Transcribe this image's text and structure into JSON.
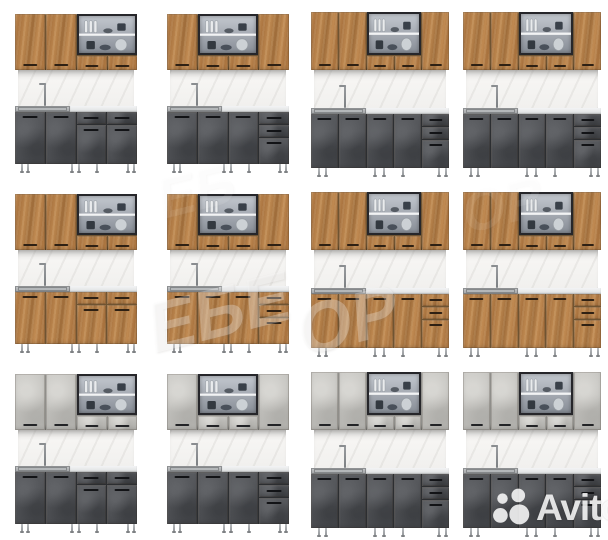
{
  "page": {
    "width": 608,
    "height": 540,
    "background": "#ffffff",
    "content_type": "product-photo-collage"
  },
  "grid": {
    "rows": 3,
    "cols": 4,
    "cell_width": 152,
    "cell_height": 180
  },
  "materials": {
    "oak": {
      "name": "oak-wood",
      "base": "#b07c46",
      "gap": "#6f5432",
      "handle": "#2e2013"
    },
    "dark": {
      "name": "dark-graphite",
      "base": "#515357",
      "gap": "#2c2e31",
      "handle": "#121316"
    },
    "concrete": {
      "name": "light-concrete",
      "base": "#c2c1bd",
      "gap": "#8f8e8a",
      "handle": "#222326"
    }
  },
  "shared_colors": {
    "backsplash": "#f2f1ef",
    "counter_sink": "#aeb1b3",
    "counter_top": "#e9ebec",
    "glass_frame": "#26262a",
    "legs": "#a5a8ab",
    "background": "#ffffff"
  },
  "layouts": {
    "compact-a": {
      "upper": [
        "door",
        "door",
        "glass"
      ],
      "upper_w": [
        1,
        1,
        2
      ],
      "lower": [
        "door",
        "door",
        "drawer-door",
        "drawer-door"
      ],
      "lower_w": [
        1,
        1,
        1,
        1
      ]
    },
    "compact-b": {
      "upper": [
        "door",
        "glass",
        "door"
      ],
      "upper_w": [
        1,
        2,
        1
      ],
      "lower": [
        "door",
        "door",
        "door",
        "drawers-door"
      ],
      "lower_w": [
        1,
        1,
        1,
        1
      ]
    },
    "wide": {
      "upper": [
        "door",
        "door",
        "glass",
        "door"
      ],
      "upper_w": [
        1,
        1,
        2,
        1
      ],
      "lower": [
        "door",
        "door",
        "door",
        "door",
        "drawers-door"
      ],
      "lower_w": [
        1,
        1,
        1,
        1,
        1
      ]
    }
  },
  "kitchens": [
    {
      "id": "kitchen-r1-c1",
      "row": 0,
      "col": 0,
      "size": "compact",
      "layout": "compact-a",
      "upper": "oak",
      "lower": "dark"
    },
    {
      "id": "kitchen-r1-c2",
      "row": 0,
      "col": 1,
      "size": "compact",
      "layout": "compact-b",
      "upper": "oak",
      "lower": "dark"
    },
    {
      "id": "kitchen-r1-c3",
      "row": 0,
      "col": 2,
      "size": "wide",
      "layout": "wide",
      "upper": "oak",
      "lower": "dark"
    },
    {
      "id": "kitchen-r1-c4",
      "row": 0,
      "col": 3,
      "size": "wide",
      "layout": "wide",
      "upper": "oak",
      "lower": "dark"
    },
    {
      "id": "kitchen-r2-c1",
      "row": 1,
      "col": 0,
      "size": "compact",
      "layout": "compact-a",
      "upper": "oak",
      "lower": "oak"
    },
    {
      "id": "kitchen-r2-c2",
      "row": 1,
      "col": 1,
      "size": "compact",
      "layout": "compact-b",
      "upper": "oak",
      "lower": "oak"
    },
    {
      "id": "kitchen-r2-c3",
      "row": 1,
      "col": 2,
      "size": "wide",
      "layout": "wide",
      "upper": "oak",
      "lower": "oak"
    },
    {
      "id": "kitchen-r2-c4",
      "row": 1,
      "col": 3,
      "size": "wide",
      "layout": "wide",
      "upper": "oak",
      "lower": "oak"
    },
    {
      "id": "kitchen-r3-c1",
      "row": 2,
      "col": 0,
      "size": "compact",
      "layout": "compact-a",
      "upper": "concrete",
      "lower": "dark"
    },
    {
      "id": "kitchen-r3-c2",
      "row": 2,
      "col": 1,
      "size": "compact",
      "layout": "compact-b",
      "upper": "concrete",
      "lower": "dark"
    },
    {
      "id": "kitchen-r3-c3",
      "row": 2,
      "col": 2,
      "size": "wide",
      "layout": "wide",
      "upper": "concrete",
      "lower": "dark"
    },
    {
      "id": "kitchen-r3-c4",
      "row": 2,
      "col": 3,
      "size": "wide",
      "layout": "wide",
      "upper": "concrete",
      "lower": "dark"
    }
  ],
  "geometry": {
    "compact": {
      "left": 15,
      "top": 14,
      "width": 122,
      "upper_h": 56,
      "splash_h": 36,
      "counter_h": 6,
      "lower_h": 52,
      "leg_h": 9,
      "short_door_h": 16,
      "sink_frac": 0.45
    },
    "wide": {
      "left": 7,
      "top": 12,
      "width": 138,
      "upper_h": 58,
      "splash_h": 38,
      "counter_h": 6,
      "lower_h": 54,
      "leg_h": 9,
      "short_door_h": 16,
      "sink_frac": 0.4
    }
  },
  "watermark": {
    "color": "rgba(255,255,255,0.52)",
    "fragments": [
      {
        "text": "ЕБЕ",
        "x": 148,
        "y": 272,
        "size": 70,
        "rotation": -14,
        "opacity": 0.52
      },
      {
        "text": "ОР",
        "x": 298,
        "y": 280,
        "size": 70,
        "rotation": -14,
        "opacity": 0.5
      },
      {
        "text": "ЕБ",
        "x": 158,
        "y": 158,
        "size": 56,
        "rotation": -14,
        "opacity": 0.16
      },
      {
        "text": "ОР",
        "x": 462,
        "y": 172,
        "size": 56,
        "rotation": -14,
        "opacity": 0.14
      }
    ]
  },
  "brand_watermark": {
    "label": "Avito",
    "dots_icon": "avito-dots-icon",
    "color": "rgba(255,255,255,0.85)",
    "x": 492,
    "y": 486
  }
}
